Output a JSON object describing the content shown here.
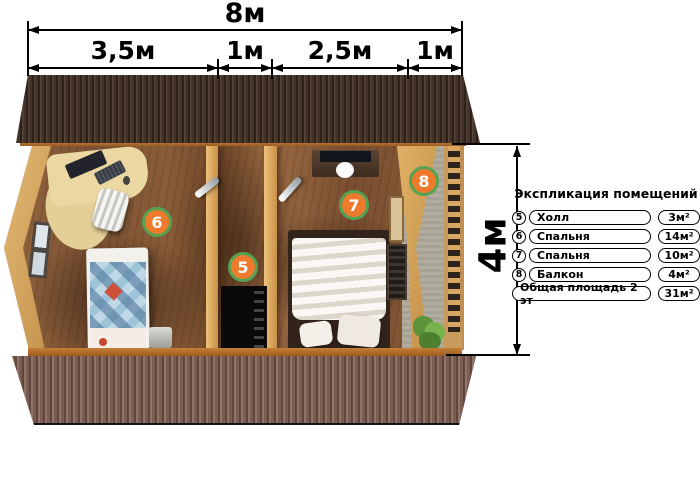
{
  "dimensions": {
    "total_width_label": "8м",
    "segment_labels": [
      "3,5м",
      "1м",
      "2,5м",
      "1м"
    ],
    "height_label": "4м"
  },
  "room_markers": [
    {
      "number": "5"
    },
    {
      "number": "6"
    },
    {
      "number": "7"
    },
    {
      "number": "8"
    }
  ],
  "legend": {
    "title": "Экспликация помещений",
    "rows": [
      {
        "number": "5",
        "name": "Холл",
        "area": "3м²"
      },
      {
        "number": "6",
        "name": "Спальня",
        "area": "14м²"
      },
      {
        "number": "7",
        "name": "Спальня",
        "area": "10м²"
      },
      {
        "number": "8",
        "name": "Балкон",
        "area": "4м²"
      }
    ],
    "total_label": "Общая площадь 2 эт",
    "total_area": "31м²"
  },
  "colors": {
    "marker_fill": "#ee7b2d",
    "marker_border": "#55a352",
    "roof_top": "#3c2e24",
    "roof_bottom": "#7b5c50",
    "floor_wood": "#8a5c38",
    "wall_pine": "#d8a85c"
  }
}
